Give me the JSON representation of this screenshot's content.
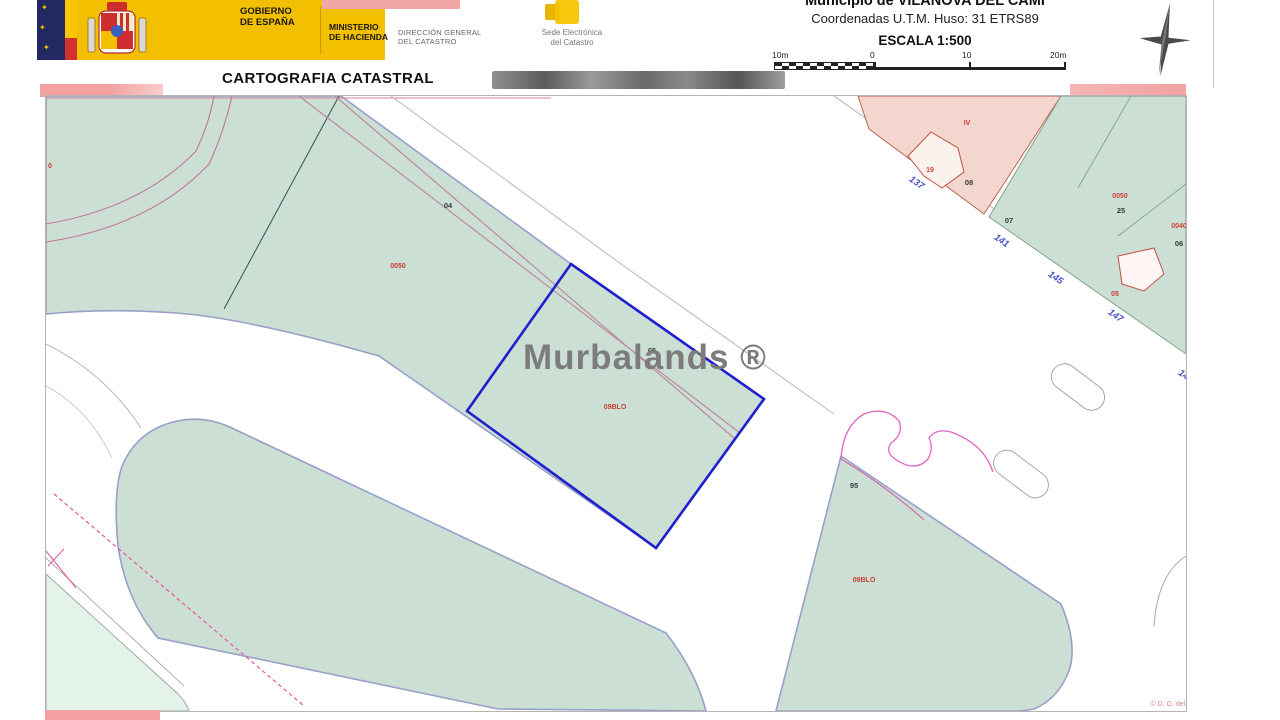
{
  "colors": {
    "gov_yellow": "#f2c000",
    "flag_navy": "#232a63",
    "flag_red": "#d03030",
    "redaction_pink": "#f2a0a0",
    "parcel_green": "#ccdfd4",
    "parcel_mint": "#e3f3ea",
    "parcel_pink": "#f3d7cf",
    "parcel_border_purple": "#98a0c8",
    "selected_parcel_blue": "#1f1fd0",
    "label_red": "#c94038",
    "label_blue": "#4a52c8",
    "magenta_line": "#e068c0",
    "watermark_gray": "#7c7c7c"
  },
  "header": {
    "gobierno_line1": "GOBIERNO",
    "gobierno_line2": "DE ESPAÑA",
    "ministerio_line1": "MINISTERIO",
    "ministerio_line2": "DE HACIENDA",
    "dgc_line1": "DIRECCIÓN GENERAL",
    "dgc_line2": "DEL CATASTRO",
    "sede_line1": "Sede Electrónica",
    "sede_line2": "del Catastro",
    "municipio": "Municipio de VILANOVA DEL CAMÍ",
    "coordenadas": "Coordenadas U.T.M. Huso: 31 ETRS89",
    "escala": "ESCALA 1:500",
    "scale_labels": [
      "10m",
      "0",
      "10",
      "20m"
    ],
    "title": "CARTOGRAFIA CATASTRAL"
  },
  "map": {
    "watermark": "Murbalands ®",
    "copyright": "© D. G. del Catastro",
    "labels": [
      {
        "text": "0",
        "x": 4,
        "y": 72,
        "cls": "red",
        "name": "parcel-label-left-edge"
      },
      {
        "text": "0050",
        "x": 352,
        "y": 172,
        "cls": "red",
        "name": "parcel-code-label"
      },
      {
        "text": "04",
        "x": 402,
        "y": 112,
        "cls": "gray",
        "name": "parcel-number-label"
      },
      {
        "text": "05",
        "x": 606,
        "y": 257,
        "cls": "gray",
        "name": "parcel-number-label"
      },
      {
        "text": "09BLO",
        "x": 569,
        "y": 313,
        "cls": "red",
        "name": "selected-parcel-code-label"
      },
      {
        "text": "95",
        "x": 808,
        "y": 392,
        "cls": "gray",
        "name": "parcel-number-label"
      },
      {
        "text": "09BLO",
        "x": 818,
        "y": 486,
        "cls": "red",
        "name": "parcel-code-label"
      },
      {
        "text": "IV",
        "x": 921,
        "y": 29,
        "cls": "red",
        "name": "parcel-code-label"
      },
      {
        "text": "19",
        "x": 884,
        "y": 76,
        "cls": "red",
        "name": "building-label"
      },
      {
        "text": "08",
        "x": 923,
        "y": 89,
        "cls": "gray",
        "name": "parcel-number-label"
      },
      {
        "text": "07",
        "x": 963,
        "y": 127,
        "cls": "gray",
        "name": "parcel-number-label"
      },
      {
        "text": "137",
        "x": 869,
        "y": 89,
        "cls": "blue",
        "rot": 35,
        "name": "street-number"
      },
      {
        "text": "141",
        "x": 954,
        "y": 147,
        "cls": "blue",
        "rot": 35,
        "name": "street-number"
      },
      {
        "text": "145",
        "x": 1008,
        "y": 184,
        "cls": "blue",
        "rot": 35,
        "name": "street-number"
      },
      {
        "text": "147",
        "x": 1068,
        "y": 222,
        "cls": "blue",
        "rot": 35,
        "name": "street-number"
      },
      {
        "text": "14",
        "x": 1136,
        "y": 281,
        "cls": "blue",
        "rot": 35,
        "name": "street-number"
      },
      {
        "text": "0050",
        "x": 1074,
        "y": 102,
        "cls": "red",
        "name": "parcel-code-label"
      },
      {
        "text": "25",
        "x": 1075,
        "y": 117,
        "cls": "gray",
        "name": "parcel-number-label"
      },
      {
        "text": "0040",
        "x": 1133,
        "y": 132,
        "cls": "red",
        "name": "parcel-code-label"
      },
      {
        "text": "06",
        "x": 1133,
        "y": 150,
        "cls": "gray",
        "name": "parcel-number-label"
      },
      {
        "text": "05",
        "x": 1069,
        "y": 200,
        "cls": "red",
        "name": "building-label"
      },
      {
        "text": "© D. G. del Catastro",
        "x": 1136,
        "y": 610,
        "cls": "pink",
        "anchor": "end",
        "name": "map-copyright"
      }
    ]
  }
}
